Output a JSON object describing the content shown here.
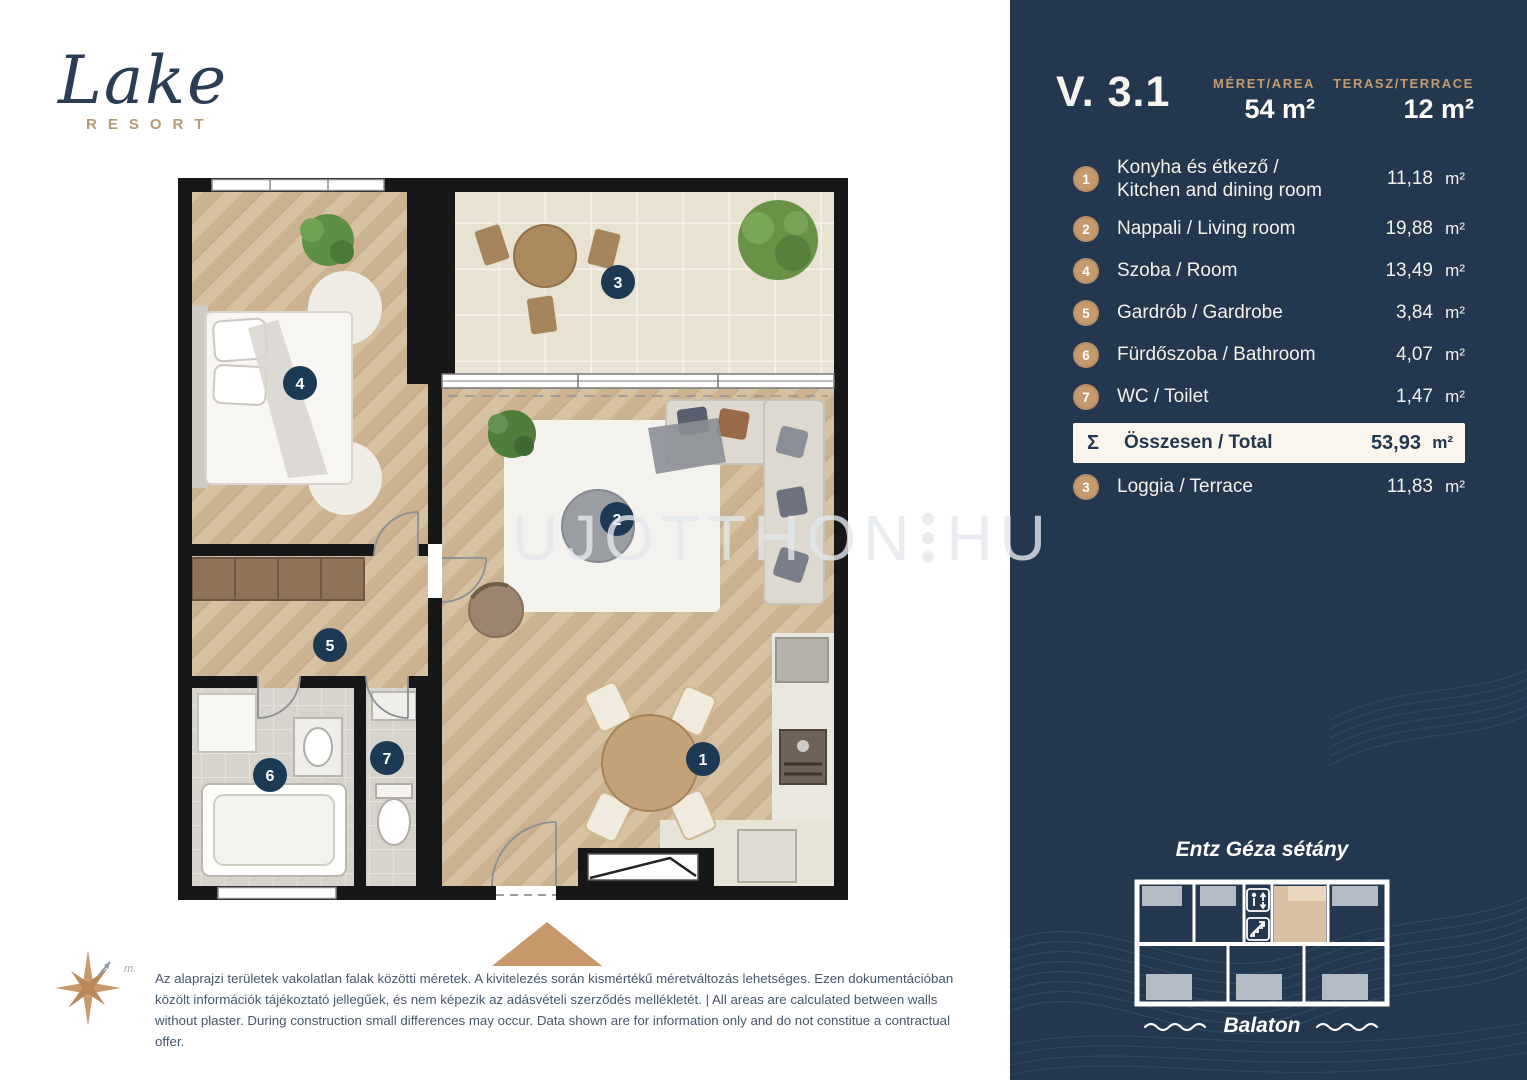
{
  "brand": {
    "name": "Lake",
    "tagline": "RESORT"
  },
  "unit_header": {
    "unit_id": "V. 3.1",
    "size_label": "MÉRET/AREA",
    "size_value": "54 m²",
    "terrace_label": "TERASZ/TERRACE",
    "terrace_value": "12 m²"
  },
  "room_list": {
    "rooms": [
      {
        "num": "1",
        "name_line1": "Konyha és étkező /",
        "name_line2": "Kitchen and dining room",
        "area": "11,18",
        "unit": "m²"
      },
      {
        "num": "2",
        "name": "Nappali / Living room",
        "area": "19,88",
        "unit": "m²"
      },
      {
        "num": "4",
        "name": "Szoba / Room",
        "area": "13,49",
        "unit": "m²"
      },
      {
        "num": "5",
        "name": "Gardrób / Gardrobe",
        "area": "3,84",
        "unit": "m²"
      },
      {
        "num": "6",
        "name": "Fürdőszoba / Bathroom",
        "area": "4,07",
        "unit": "m²"
      },
      {
        "num": "7",
        "name": "WC / Toilet",
        "area": "1,47",
        "unit": "m²"
      }
    ],
    "total": {
      "symbol": "Σ",
      "name": "Összesen / Total",
      "area": "53,93",
      "unit": "m²"
    },
    "loggia": {
      "num": "3",
      "name": "Loggia / Terrace",
      "area": "11,83",
      "unit": "m²"
    }
  },
  "plan_markers": {
    "kitchen": "1",
    "living": "2",
    "loggia": "3",
    "room": "4",
    "wardrobe": "5",
    "bathroom": "6",
    "wc": "7"
  },
  "minimap": {
    "street": "Entz Géza sétány",
    "lake": "Balaton"
  },
  "watermark": {
    "part1": "UJOTTHON",
    "part2": "HU"
  },
  "disclaimer": "Az alaprajzi területek vakolatlan falak közötti méretek. A kivitelezés során kismértékű méretváltozás lehetséges. Ezen dokumentációban közölt információk tájékoztató jellegűek, és nem képezik az adásvételi szerződés mellékletét. | All areas are calculated between walls without plaster. During construction small differences may occur. Data shown are for information only and do not constitue a contractual offer.",
  "colors": {
    "sidebar_navy": "#23384f",
    "accent_gold": "#c49a6e",
    "cream_row": "#faf6ee",
    "marker_navy": "#1d3a55",
    "highlight_tan": "#d9bfa3",
    "wall_black": "#171717"
  }
}
